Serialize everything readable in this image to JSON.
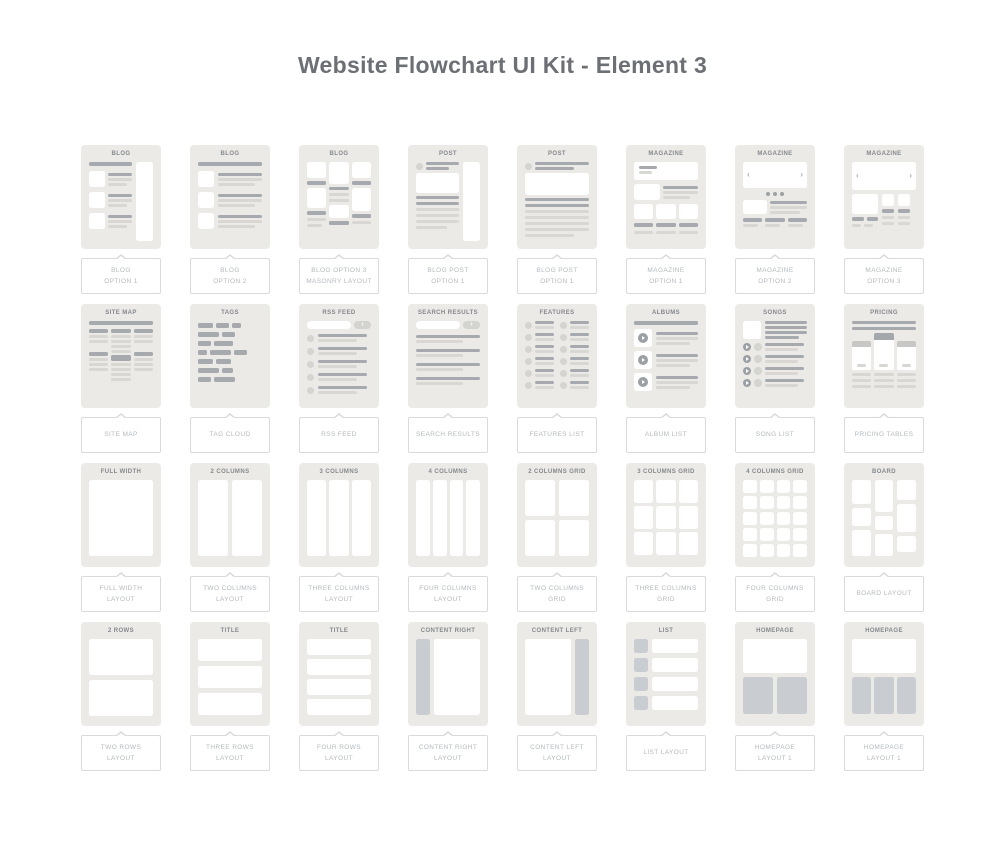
{
  "page": {
    "title": "Website Flowchart UI Kit - Element 3"
  },
  "icons": {
    "chevron_left": "‹",
    "chevron_right": "›",
    "play": "play-triangle-in-circle",
    "carousel_dots": "three-dots"
  },
  "colors": {
    "page_bg": "#FFFFFF",
    "title_text": "#6C7075",
    "card_bg": "#ECEAE6",
    "card_title_text": "#84888E",
    "bar_dark": "#A6AAAF",
    "bar_light": "#D8D7D4",
    "block_gray": "#C9CCD0",
    "circle_dark": "#9BA0A5",
    "circle_light": "#D4D4D1",
    "label_text": "#B4B9BE",
    "label_border": "#DADADA",
    "white": "#FFFFFF"
  },
  "cards": [
    {
      "title": "BLOG",
      "label": "BLOG\nOPTION 1",
      "wireframe": "blog-list-with-right-sidebar"
    },
    {
      "title": "BLOG",
      "label": "BLOG\nOPTION 2",
      "wireframe": "blog-list-full-width"
    },
    {
      "title": "BLOG",
      "label": "BLOG OPTION 3\nMASONRY LAYOUT",
      "wireframe": "blog-masonry-three-columns"
    },
    {
      "title": "POST",
      "label": "BLOG POST\nOPTION 1",
      "wireframe": "post-with-right-sidebar"
    },
    {
      "title": "POST",
      "label": "BLOG POST\nOPTION 1",
      "wireframe": "post-full-width"
    },
    {
      "title": "MAGAZINE",
      "label": "MAGAZINE\nOPTION 1",
      "wireframe": "magazine-hero-and-teasers"
    },
    {
      "title": "MAGAZINE",
      "label": "MAGAZINE\nOPTION 2",
      "wireframe": "magazine-carousel-with-dots"
    },
    {
      "title": "MAGAZINE",
      "label": "MAGAZINE\nOPTION 3",
      "wireframe": "magazine-carousel-two-teasers"
    },
    {
      "title": "SITE MAP",
      "label": "SITE MAP",
      "wireframe": "sitemap-three-column-tree"
    },
    {
      "title": "TAGS",
      "label": "TAG CLOUD",
      "wireframe": "tag-cloud"
    },
    {
      "title": "RSS FEED",
      "label": "RSS FEED",
      "wireframe": "feed-list-with-search"
    },
    {
      "title": "SEARCH RESULTS",
      "label": "SEARCH RESULTS",
      "wireframe": "search-results-list"
    },
    {
      "title": "FEATURES",
      "label": "FEATURES LIST",
      "wireframe": "features-two-column-list"
    },
    {
      "title": "ALBUMS",
      "label": "ALBUM LIST",
      "wireframe": "album-list-with-play"
    },
    {
      "title": "SONGS",
      "label": "SONG LIST",
      "wireframe": "song-list-with-play"
    },
    {
      "title": "PRICING",
      "label": "PRICING TABLES",
      "wireframe": "three-pricing-tables"
    },
    {
      "title": "FULL WIDTH",
      "label": "FULL WIDTH\nLAYOUT",
      "wireframe": "one-full-width-block"
    },
    {
      "title": "2 COLUMNS",
      "label": "TWO COLUMNS\nLAYOUT",
      "wireframe": "two-columns"
    },
    {
      "title": "3 COLUMNS",
      "label": "THREE COLUMNS\nLAYOUT",
      "wireframe": "three-columns"
    },
    {
      "title": "4 COLUMNS",
      "label": "FOUR COLUMNS\nLAYOUT",
      "wireframe": "four-columns"
    },
    {
      "title": "2 COLUMNS GRID",
      "label": "TWO COLUMNS\nGRID",
      "wireframe": "two-by-two-grid"
    },
    {
      "title": "3 COLUMNS GRID",
      "label": "THREE COLUMNS\nGRID",
      "wireframe": "three-by-three-grid"
    },
    {
      "title": "4 COLUMNS GRID",
      "label": "FOUR COLUMNS\nGRID",
      "wireframe": "four-by-five-grid"
    },
    {
      "title": "BOARD",
      "label": "BOARD LAYOUT",
      "wireframe": "masonry-board"
    },
    {
      "title": "2 ROWS",
      "label": "TWO ROWS\nLAYOUT",
      "wireframe": "two-rows"
    },
    {
      "title": "TITLE",
      "label": "THREE ROWS\nLAYOUT",
      "wireframe": "three-rows"
    },
    {
      "title": "TITLE",
      "label": "FOUR ROWS\nLAYOUT",
      "wireframe": "four-rows"
    },
    {
      "title": "CONTENT RIGHT",
      "label": "CONTENT RIGHT\nLAYOUT",
      "wireframe": "sidebar-left-content-right"
    },
    {
      "title": "CONTENT LEFT",
      "label": "CONTENT LEFT\nLAYOUT",
      "wireframe": "content-left-sidebar-right"
    },
    {
      "title": "LIST",
      "label": "LIST LAYOUT",
      "wireframe": "thumbnail-list"
    },
    {
      "title": "HOMEPAGE",
      "label": "HOMEPAGE\nLAYOUT 1",
      "wireframe": "hero-with-two-blocks"
    },
    {
      "title": "HOMEPAGE",
      "label": "HOMEPAGE\nLAYOUT 1",
      "wireframe": "hero-with-three-blocks"
    }
  ]
}
